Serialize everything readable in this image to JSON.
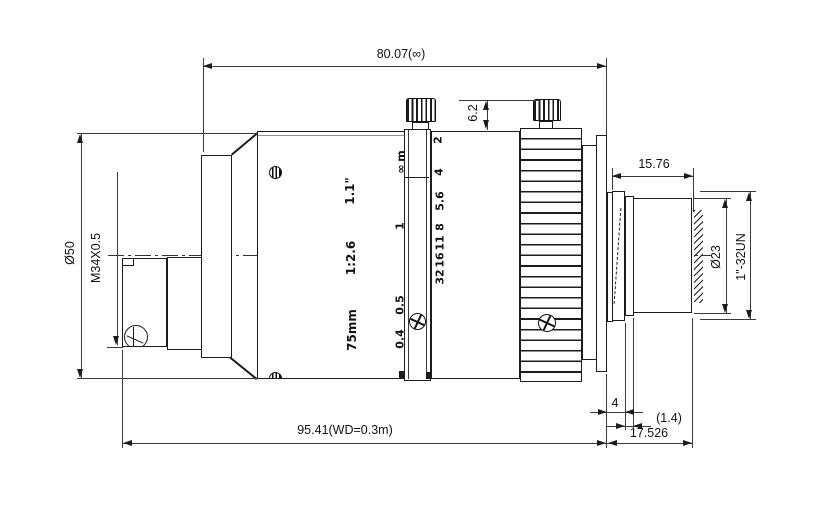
{
  "dimensions": {
    "length_to_image_plane": "80.07(∞)",
    "screw_protrusion": "6.2",
    "body_diameter": "Ø50",
    "front_filter_thread": "M34X0.5",
    "rear_protrusion_length": "15.76",
    "rear_tube_diameter": "Ø23",
    "mount_thread": "1\"-32UN",
    "overall_length": "95.41(WD=0.3m)",
    "rear_step": "4",
    "rear_lip": "(1.4)",
    "flange_focal_distance": "17.526"
  },
  "markings": {
    "focal_length": "75mm",
    "aperture_ratio": "1:2.6",
    "image_format": "1.1\"",
    "focus_scale": [
      "m",
      "∞",
      "1",
      "0.5",
      "0.4"
    ],
    "aperture_scale": [
      "2",
      "4",
      "5.6",
      "8",
      "11",
      "16",
      "32"
    ]
  }
}
